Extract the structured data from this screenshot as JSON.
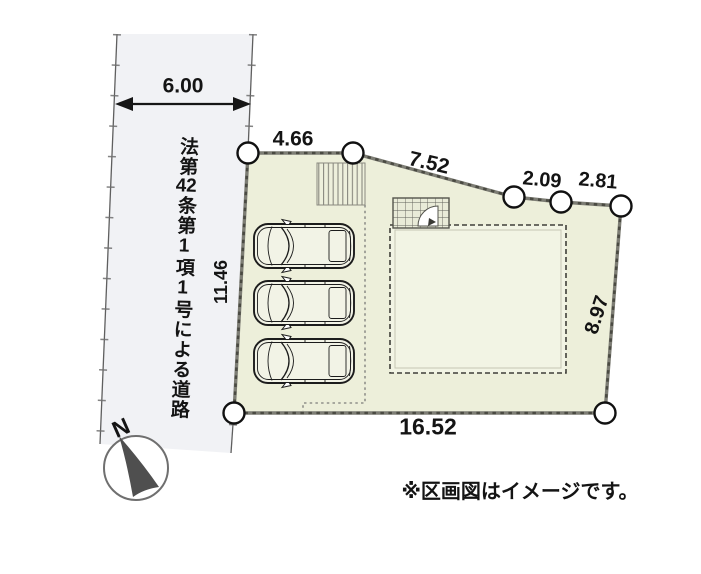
{
  "diagram": {
    "road": {
      "name_label": "法第42条第1項1号による道路",
      "name_parts": {
        "before": "法第",
        "combined_digits": "42",
        "after": "条第1項1号による道路"
      },
      "width_dimension": "6.00"
    },
    "plot": {
      "dimensions": {
        "top": "4.66",
        "northeast": "7.52",
        "east_upper_1": "2.09",
        "east_upper_2": "2.81",
        "left": "11.46",
        "right": "8.97",
        "bottom": "16.52"
      },
      "vertex_count": 7
    },
    "parking": {
      "car_count": 3
    },
    "compass": {
      "north_label": "N"
    },
    "footnote": "※区画図はイメージです。",
    "colors": {
      "plot_fill": "#edefda",
      "building_fill": "#f2f4e4",
      "road_fill": "#f1f2f5",
      "boundary": "#7d7d74",
      "boundary_dash": "#4a4a42",
      "line_dark": "#161616",
      "needle": "#4f4f4f"
    }
  }
}
